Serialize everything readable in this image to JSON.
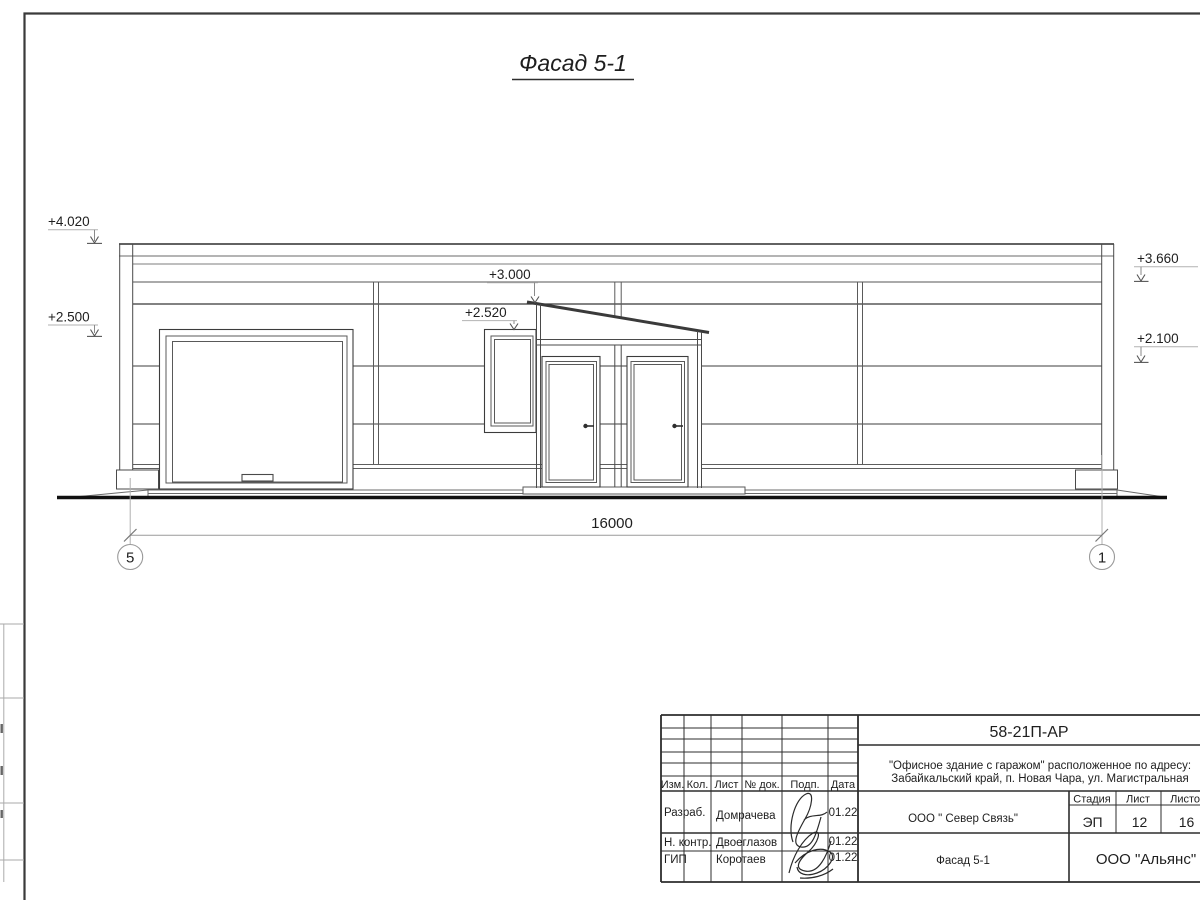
{
  "drawing": {
    "title": "Фасад 5-1",
    "dimension_total": "16000",
    "axis_left": "5",
    "axis_right": "1",
    "elevation_marks": {
      "parapet_left": "+4.020",
      "garage_top": "+2.500",
      "canopy_top": "+3.000",
      "window_top": "+2.520",
      "parapet_right": "+3.660",
      "wall_right": "+2.100"
    }
  },
  "title_block": {
    "doc_number": "58-21П-АР",
    "project_line1": "\"Офисное здание с гаражом\" расположенное по адресу:",
    "project_line2": "Забайкальский край, п. Новая Чара, ул. Магистральная",
    "columns": {
      "izm": "Изм.",
      "kol": "Кол.",
      "list": "Лист",
      "doc": "№ док.",
      "podp": "Подп.",
      "data": "Дата"
    },
    "rows": [
      {
        "role": "Разраб.",
        "name": "Домрачева",
        "date": "01.22"
      },
      {
        "role": "Н. контр.",
        "name": "Двоеглазов",
        "date": "01.22"
      },
      {
        "role": "ГИП",
        "name": "Коротаев",
        "date": "01.22"
      }
    ],
    "company": "ООО \" Север Связь\"",
    "stage_label": "Стадия",
    "stage": "ЭП",
    "sheet_label": "Лист",
    "sheet_no": "12",
    "sheets_label": "Листов",
    "sheets_total": "16",
    "drawing_name": "Фасад 5-1",
    "org": "ООО \"Альянс\""
  }
}
